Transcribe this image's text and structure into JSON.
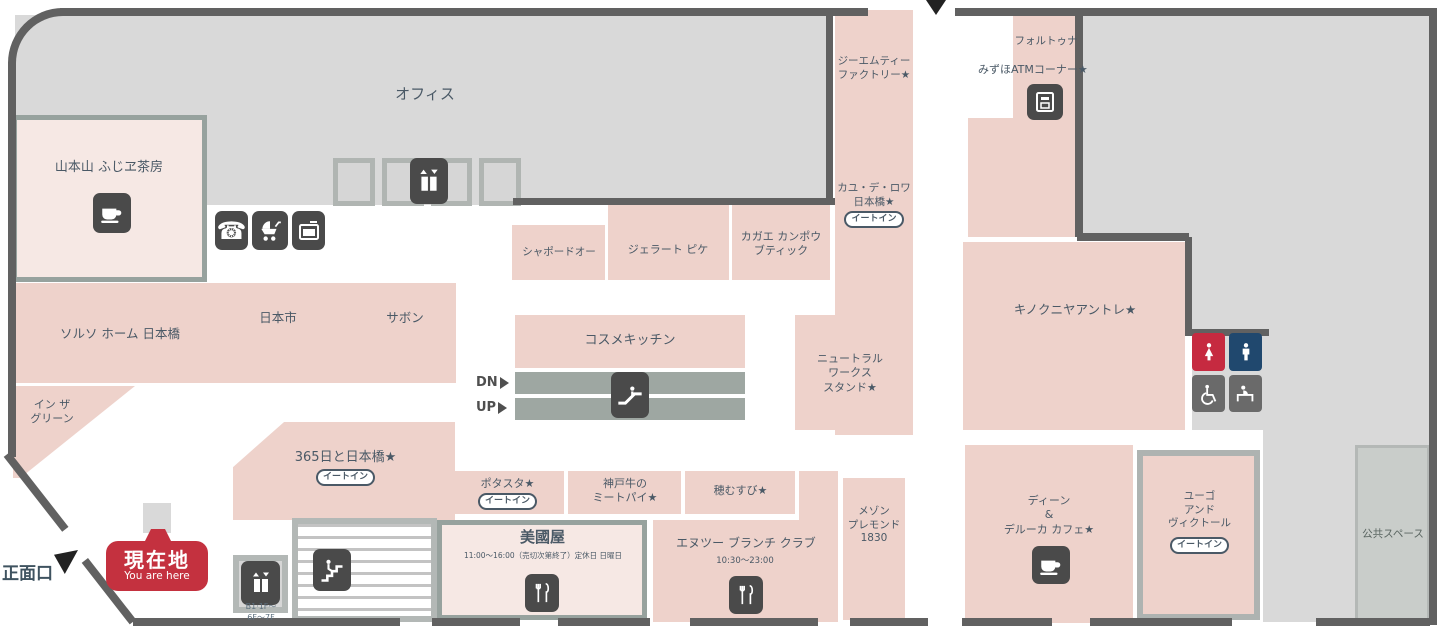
{
  "labels": {
    "office": "オフィス",
    "public_space": "公共スペース",
    "front_entrance": "正面口",
    "you_are_here_jp": "現在地",
    "you_are_here_en": "You are here",
    "dn": "DN",
    "up": "UP",
    "elevator_floors": "B1·1F～\n6F～7F",
    "atm_corner": "みずほATMコーナー★"
  },
  "badges": {
    "eat_in": "イートイン"
  },
  "shops": {
    "yamamotoyama": "山本山 ふじヱ茶房",
    "solso_home": "ソルソ ホーム 日本橋",
    "nihonichi": "日本市",
    "sabon": "サボン",
    "in_the_green": "イン ザ\nグリーン",
    "chapeau_do": "シャポードオー",
    "gelato_pique": "ジェラート ピケ",
    "kagae_kampo": "カガエ カンポウ\nブティック",
    "cosme_kitchen": "コスメキッチン",
    "neutralworks": "ニュートラル\nワークス\nスタンド★",
    "gmt_factory": "ジーエムティー\nファクトリー★",
    "cayu_de_roi": "カユ・デ・ロワ\n日本橋★",
    "fortuna": "フォルトゥナ",
    "kinokuniya_entree": "キノクニヤアントレ★",
    "365_nihonbashi": "365日と日本橋★",
    "potasta": "ポタスタ★",
    "kobe_meat_pie": "神戸牛の\nミートパイ★",
    "homusubi": "穂むすび★",
    "mikuniya": "美國屋",
    "mikuniya_hours": "11:00～16:00（売切次第終了）定休日 日曜日",
    "n2_brunch_club": "エヌツー ブランチ クラブ",
    "n2_hours": "10:30～23:00",
    "maison_bremond": "メゾン\nプレモンド\n1830",
    "dean_deluca_cafe": "ディーン\n&\nデルーカ カフェ★",
    "hugo_victor": "ユーゴ\nアンド\nヴィクトール"
  }
}
